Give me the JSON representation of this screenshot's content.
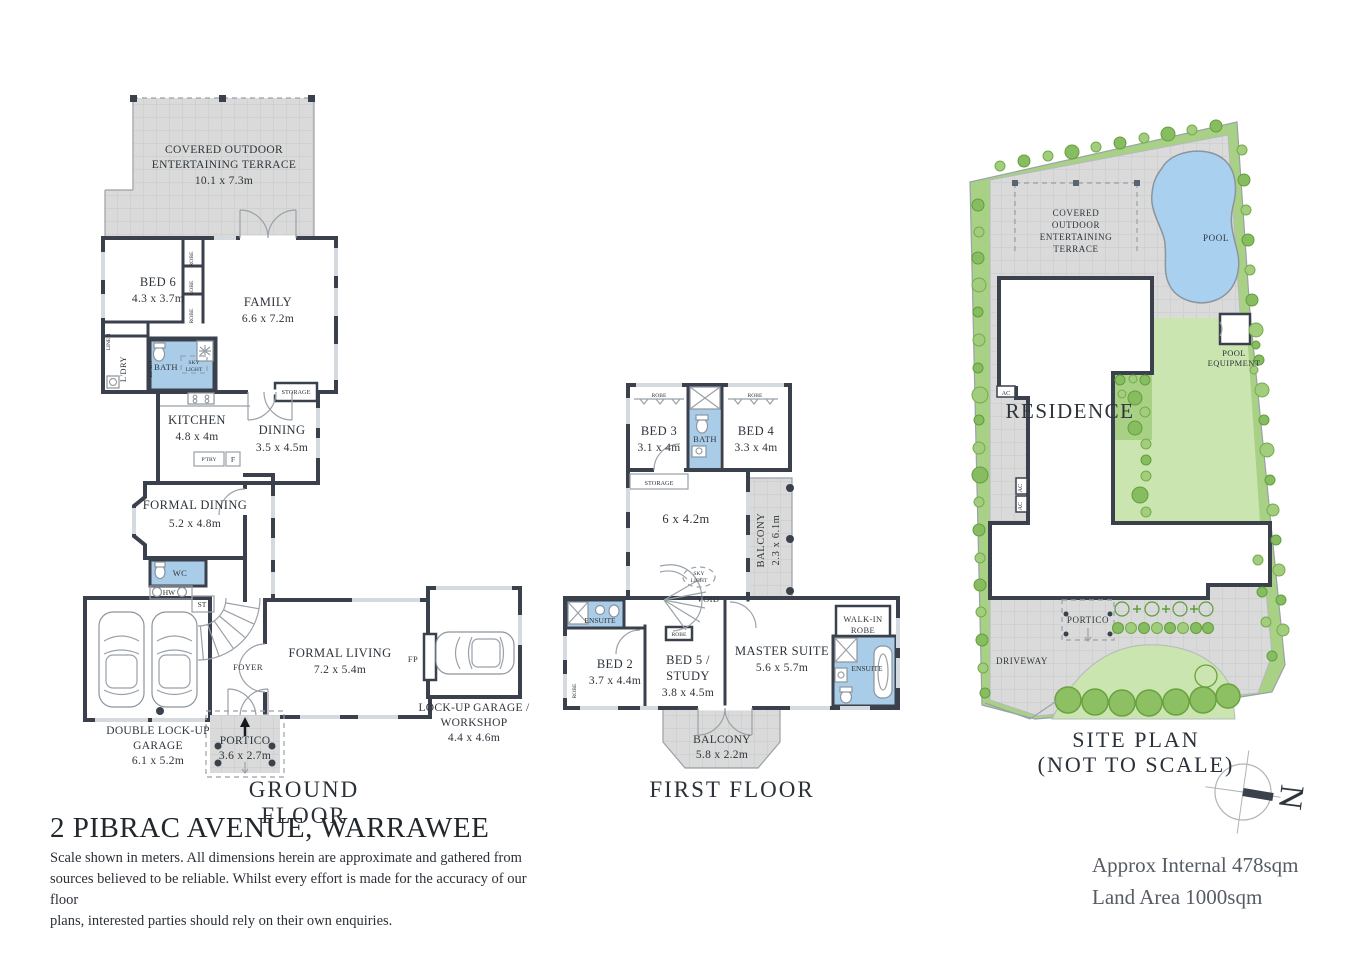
{
  "page": {
    "address": "2 PIBRAC AVENUE, WARRAWEE",
    "disclaimer": [
      "Scale shown in meters. All dimensions herein are approximate and gathered from",
      "sources believed to be  reliable. Whilst every effort is made for the accuracy of our floor",
      "plans, interested parties should rely on their own enquiries."
    ],
    "areas": {
      "internal": "Approx Internal 478sqm",
      "land": "Land Area 1000sqm"
    },
    "compass_label": "N"
  },
  "ground_floor": {
    "title": "GROUND FLOOR",
    "terrace": {
      "l1": "COVERED OUTDOOR",
      "l2": "ENTERTAINING TERRACE",
      "dims": "10.1 x 7.3m"
    },
    "rooms": {
      "bed6": {
        "name": "BED 6",
        "dims": "4.3 x 3.7m"
      },
      "family": {
        "name": "FAMILY",
        "dims": "6.6 x 7.2m"
      },
      "kitchen": {
        "name": "KITCHEN",
        "dims": "4.8 x 4m"
      },
      "dining": {
        "name": "DINING",
        "dims": "3.5 x 4.5m"
      },
      "formal_dining": {
        "name": "FORMAL DINING",
        "dims": "5.2 x 4.8m"
      },
      "formal_living": {
        "name": "FORMAL LIVING",
        "dims": "7.2 x 5.4m"
      },
      "double_garage": {
        "l1": "DOUBLE LOCK-UP",
        "l2": "GARAGE",
        "dims": "6.1 x 5.2m"
      },
      "workshop_garage": {
        "l1": "LOCK-UP GARAGE /",
        "l2": "WORKSHOP",
        "dims": "4.4 x 4.6m"
      },
      "portico": {
        "name": "PORTICO",
        "dims": "3.6 x 2.7m"
      }
    },
    "labels": {
      "bath": "BATH",
      "sky": "SKY",
      "light": "LIGHT",
      "ldry": "L'DRY",
      "linen": "LINEN",
      "robe": "ROBE",
      "storage": "STORAGE",
      "ptry": "P'TRY",
      "fridge": "F",
      "wc": "WC",
      "hw": "HW",
      "st": "ST",
      "foyer": "FOYER",
      "fp": "FP"
    }
  },
  "first_floor": {
    "title": "FIRST FLOOR",
    "rooms": {
      "bed3": {
        "name": "BED 3",
        "dims": "3.1 x 4m"
      },
      "bed4": {
        "name": "BED 4",
        "dims": "3.3 x 4m"
      },
      "landing": {
        "dims": "6 x 4.2m"
      },
      "balcony_side": {
        "name": "BALCONY",
        "dims": "2.3 x 6.1m"
      },
      "bed2": {
        "name": "BED 2",
        "dims": "3.7 x 4.4m"
      },
      "bed5": {
        "l1": "BED 5 /",
        "l2": "STUDY",
        "dims": "3.8 x 4.5m"
      },
      "master": {
        "name": "MASTER SUITE",
        "dims": "5.6 x 5.7m"
      },
      "balcony_front": {
        "name": "BALCONY",
        "dims": "5.8 x 2.2m"
      }
    },
    "labels": {
      "bath": "BATH",
      "robe": "ROBE",
      "storage": "STORAGE",
      "sky": "SKY",
      "light": "LIGHT",
      "void": "VOID",
      "ensuite": "ENSUITE",
      "wir1": "WALK-IN",
      "wir2": "ROBE"
    }
  },
  "site_plan": {
    "title1": "SITE PLAN",
    "title2": "(NOT TO SCALE)",
    "labels": {
      "terrace": [
        "COVERED",
        "OUTDOOR",
        "ENTERTAINING",
        "TERRACE"
      ],
      "pool": "POOL",
      "residence": "RESIDENCE",
      "pool_equipment": [
        "POOL",
        "EQUIPMENT"
      ],
      "portico": "PORTICO",
      "driveway": "DRIVEWAY",
      "ac": "AC"
    }
  },
  "colors": {
    "wall": "#3a414c",
    "wet_area": "#a9cde9",
    "paving": "#d8d9d9",
    "lawn": "#cbe5b1",
    "garden_bed": "#a9d185",
    "tree": "#87bd60",
    "pool": "#a9d1ef"
  }
}
